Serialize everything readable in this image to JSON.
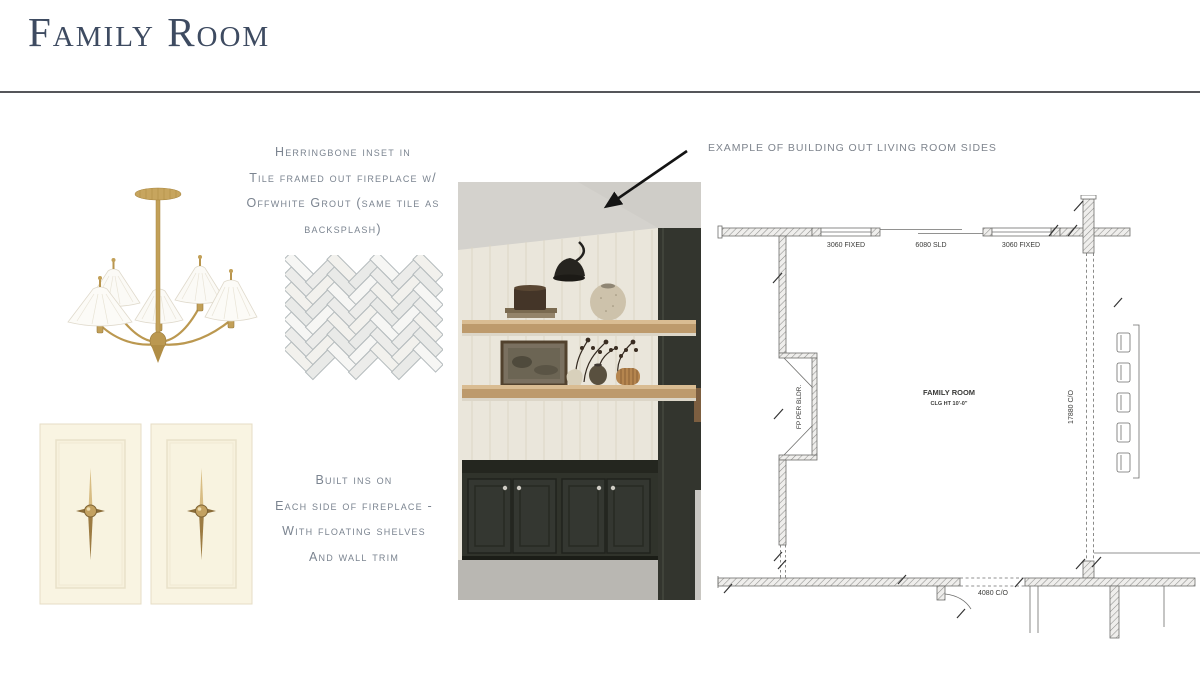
{
  "slide": {
    "title": "Family Room"
  },
  "notes": {
    "tile": {
      "lines": [
        "Herringbone inset in",
        "Tile framed out fireplace w/",
        "Offwhite Grout (same tile as",
        "backsplash)"
      ]
    },
    "builtins": {
      "lines": [
        "Built ins on",
        "Each side of fireplace -",
        "With floating shelves",
        "And wall trim"
      ]
    },
    "example": "EXAMPLE OF BUILDING OUT LIVING ROOM SIDES"
  },
  "floor_plan": {
    "room_name": "FAMILY ROOM",
    "ceiling_height": "CLG HT 10'-0\"",
    "window_left": "3060 FIXED",
    "sliding_door": "6080 SLD",
    "window_right": "3060 FIXED",
    "fireplace": "FP PER BLDR.",
    "side_opening": "17880 C/O",
    "bottom_opening": "4080 C/O"
  },
  "colors": {
    "accent_title": "#3e4b61",
    "note_text": "#7b8490",
    "brass": "#c2a058",
    "plan_ink": "#3a3a38"
  }
}
